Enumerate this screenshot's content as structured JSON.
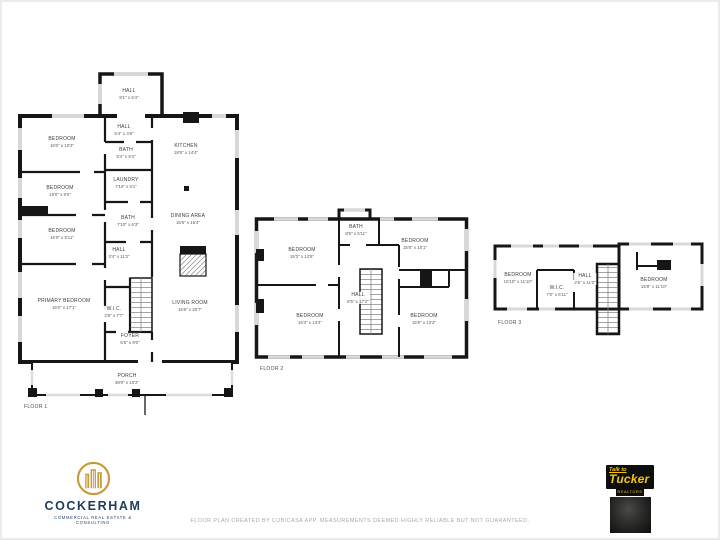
{
  "floors": [
    {
      "label": "FLOOR 1",
      "rooms": [
        {
          "name": "HALL",
          "dims": "8'1\" x 5'4\""
        },
        {
          "name": "HALL",
          "dims": "5'4\" x 4'8\""
        },
        {
          "name": "BEDROOM",
          "dims": "16'0\" x 10'3\""
        },
        {
          "name": "BATH",
          "dims": "5'4\" x 5'4\""
        },
        {
          "name": "KITCHEN",
          "dims": "18'6\" x 14'4\""
        },
        {
          "name": "BEDROOM",
          "dims": "16'0\" x 9'0\""
        },
        {
          "name": "LAUNDRY",
          "dims": "7'10\" x 6'1\""
        },
        {
          "name": "BATH",
          "dims": "7'10\" x 6'3\""
        },
        {
          "name": "DINING AREA",
          "dims": "15'6\" x 16'4\""
        },
        {
          "name": "BEDROOM",
          "dims": "16'0\" x 8'11\""
        },
        {
          "name": "HALL",
          "dims": "3'4\" x 11'2\""
        },
        {
          "name": "PRIMARY BEDROOM",
          "dims": "16'0\" x 17'1\""
        },
        {
          "name": "W.I.C.",
          "dims": "3'8\" x 7'7\""
        },
        {
          "name": "LIVING ROOM",
          "dims": "15'6\" x 20'7\""
        },
        {
          "name": "FOYER",
          "dims": "6'5\" x 9'0\""
        },
        {
          "name": "PORCH",
          "dims": "39'0\" x 10'2\""
        }
      ]
    },
    {
      "label": "FLOOR 2",
      "rooms": [
        {
          "name": "BATH",
          "dims": "8'5\" x 5'11\""
        },
        {
          "name": "BEDROOM",
          "dims": "15'3\" x 12'8\""
        },
        {
          "name": "BEDROOM",
          "dims": "15'6\" x 10'1\""
        },
        {
          "name": "HALL",
          "dims": "8'5\" x 17'2\""
        },
        {
          "name": "BEDROOM",
          "dims": "15'3\" x 13'4\""
        },
        {
          "name": "BEDROOM",
          "dims": "15'6\" x 13'3\""
        }
      ]
    },
    {
      "label": "FLOOR 3",
      "rooms": [
        {
          "name": "BEDROOM",
          "dims": "15'10\" x 11'10\""
        },
        {
          "name": "W.I.C.",
          "dims": "7'0\" x 6'11\""
        },
        {
          "name": "HALL",
          "dims": "2'6\" x 11'0\""
        },
        {
          "name": "BEDROOM",
          "dims": "15'8\" x 11'10\""
        }
      ]
    }
  ],
  "branding": {
    "cockerham": {
      "name": "COCKERHAM",
      "tagline": "COMMERCIAL REAL ESTATE & CONSULTING",
      "gold": "#c49a3c",
      "navy": "#1c3c5e"
    },
    "tucker": {
      "line1": "Talk to",
      "line2": "Tucker",
      "line3": "REALTORS",
      "yellow": "#f6c50a",
      "black": "#0e0e0e"
    }
  },
  "footer": {
    "disclaimer": "FLOOR PLAN CREATED BY CUBICASA APP. MEASUREMENTS DEEMED HIGHLY RELIABLE BUT NOT GUARANTEED."
  }
}
